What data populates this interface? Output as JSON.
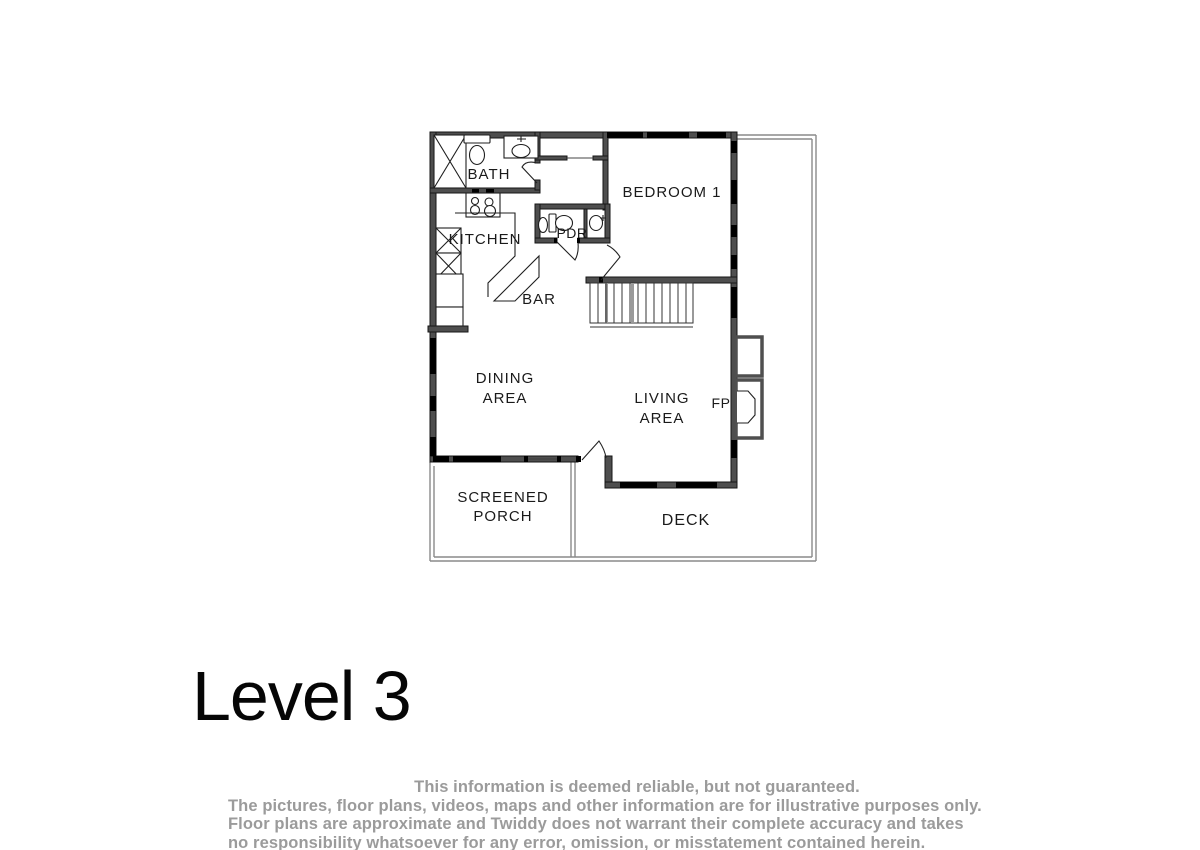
{
  "title": "Level 3",
  "floorplan": {
    "rooms": {
      "bath": "BATH",
      "bedroom1": "BEDROOM 1",
      "kitchen": "KITCHEN",
      "pdr": "PDR",
      "bar": "BAR",
      "dining": "DINING\nAREA",
      "living": "LIVING\nAREA",
      "fireplace": "FP",
      "screened_porch": "SCREENED\nPORCH",
      "deck": "DECK"
    }
  },
  "disclaimer": {
    "line1": "This information is deemed reliable, but not guaranteed.",
    "line2": "The pictures, floor plans, videos, maps and other information are for illustrative purposes only.",
    "line3": "Floor plans are approximate and Twiddy does not warrant their complete accuracy and takes",
    "line4": "no responsibility whatsoever for any error, omission, or misstatement contained herein."
  },
  "colors": {
    "wall": "#4e4e4e",
    "window": "#000000",
    "thin_line": "#8a8a8a",
    "text": "#1a1a1a",
    "disclaimer": "#9b9b9b"
  }
}
